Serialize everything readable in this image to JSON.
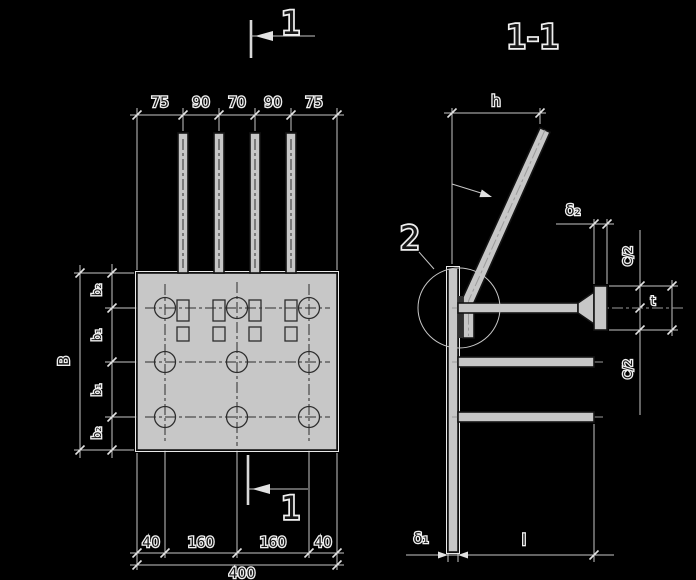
{
  "colors": {
    "background": "#000000",
    "dimension_line": "#c6c6c6",
    "shape_fill": "#c7c7c7",
    "shape_stroke": "#141414",
    "text": "#181818",
    "text_halo": "#f0f0f0"
  },
  "plan_view": {
    "section_mark_top": "1",
    "section_mark_bottom": "1",
    "top_dims": [
      "75",
      "90",
      "70",
      "90",
      "75"
    ],
    "left_overall": "B",
    "left_dims": [
      "b₂",
      "b₁",
      "b₁",
      "b₂"
    ],
    "bottom_dims": [
      "40",
      "160",
      "160",
      "40"
    ],
    "bottom_overall": "400"
  },
  "section_view": {
    "title": "1-1",
    "detail_callout": "2",
    "dims": {
      "height": "h",
      "plate2_thickness": "δ₂",
      "c_half_top": "C/2",
      "head_t": "t",
      "c_half_bottom": "C/2",
      "plate1_thickness": "δ₁",
      "stud_length": "l"
    }
  }
}
